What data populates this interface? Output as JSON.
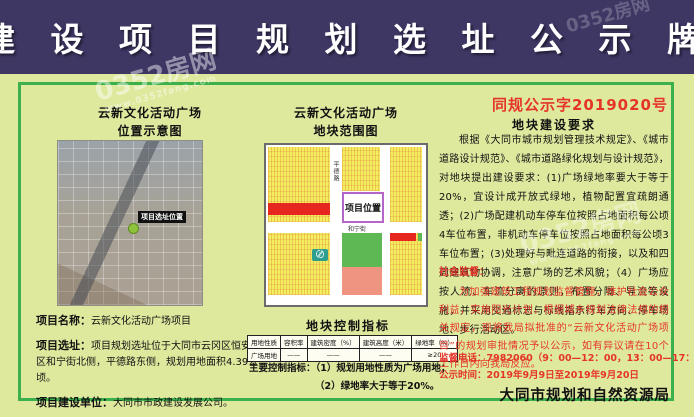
{
  "banner": {
    "title": "建 设 项 目 规 划 选 址 公 示 牌"
  },
  "left_panel": {
    "title_line1": "云新文化活动广场",
    "title_line2": "位置示意图",
    "map_marker_label": "项目选址位置",
    "fields": [
      {
        "label": "项目名称：",
        "value": "云新文化活动广场项目"
      },
      {
        "label": "项目选址：",
        "value": "项目规划选址位于大同市云冈区恒安新区和宁街北侧，平德路东侧，规划用地面积4.39公顷。"
      },
      {
        "label": "项目建设单位：",
        "value": "大同市市政建设发展公司。"
      }
    ]
  },
  "middle_panel": {
    "title_line1": "云新文化活动广场",
    "title_line2": "地块范围图",
    "plan": {
      "project_box_label": "项目位置",
      "road_vertical": "平德路",
      "road_horizontal": "和宁街"
    },
    "indicators": {
      "heading": "地块控制指标",
      "table": {
        "headers": [
          "用地性质",
          "容积率",
          "建筑密度（%）",
          "建筑高度（米）",
          "绿地率（%）"
        ],
        "rows": [
          [
            "广场用地",
            "——",
            "——",
            "——",
            "≥20"
          ]
        ]
      },
      "notes_label": "主要控制指标：",
      "notes": [
        "（1）规划用地性质为广场用地；",
        "（2）绿地率大于等于20%。"
      ]
    }
  },
  "right_panel": {
    "doc_number": "同规公示字2019020号",
    "requirements_heading": "地块建设要求",
    "requirements_body": "根据《大同市城市规划管理技术规定》、《城市道路设计规范》、《城市道路绿化规划与设计规范》，对地块提出建设要求：(1)广场绿地率要大于等于20%，宜设计成开放式绿地，植物配置宜疏朗通透；(2)广场配建机动车停车位按照占地面积每公顷4车位布置，非机动车停车位按照占地面积每公顷3车位布置；(3)处理好与毗连道路的衔接，以及和四周建筑物协调，注意广场的艺术风貌；（4）广场应按人流、车流分离的原则，布置分隔、导流等设施，并采用交通标志与标线指示行车方向、停车场地、步行活动区。",
    "supervision_heading": "社会监督：",
    "supervision_body": "为加强建筑工程规划监督管理，维护社会公众利益，实施阳光计划，根据城乡规划法律法规的相关规定，现将我局拟批准的“云新文化活动广场项目”的规划审批情况予以公示，如有异议请在10个工作日内向我局反应。",
    "phone_line": "监督电话：7982060（9：00—12：00，13：00—17：00）",
    "period_line": "公示时间：2019年9月9日至2019年9月20日",
    "agency": "大同市规划和自然资源局"
  },
  "watermark": {
    "site_name": "0352房网",
    "site_url": "www.0352fang.com"
  },
  "colors": {
    "banner_bg": "#3e3663",
    "page_bg": "#dfe99e",
    "frame_green": "#3cb04c",
    "accent_red": "#e5352b",
    "parcel_yellow": "#f2ee60",
    "parcel_green": "#5eb954",
    "parcel_salmon": "#ef9480",
    "parcel_red": "#e5271f",
    "project_box_border": "#b565c9"
  }
}
